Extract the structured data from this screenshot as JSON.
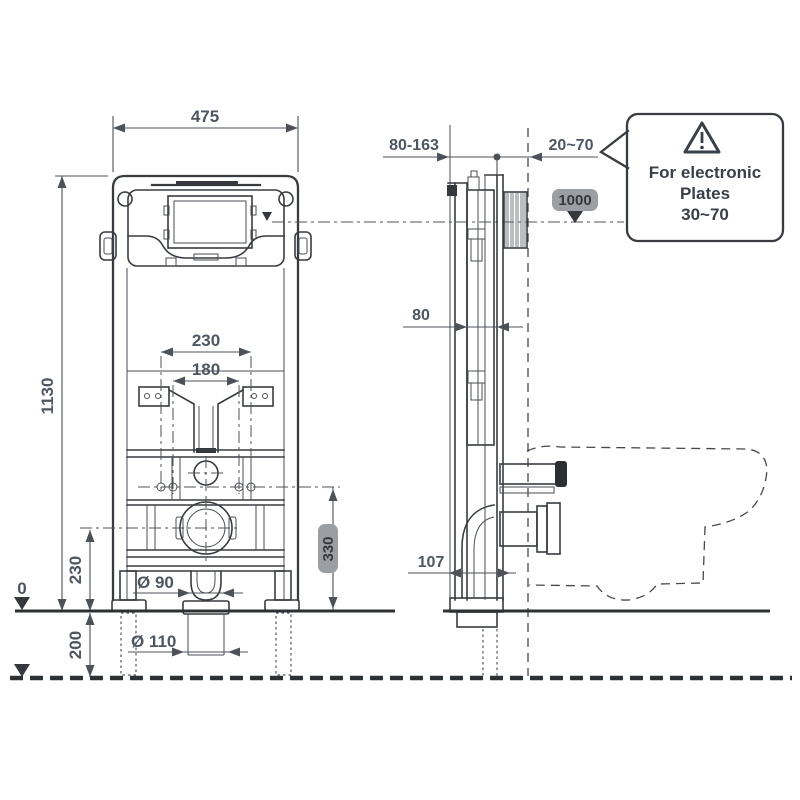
{
  "front_view": {
    "width": "475",
    "height": "1130",
    "fixing_width_outer": "230",
    "fixing_width_inner": "180",
    "outlet_center_height": "230",
    "floor_depth": "200",
    "zero_level": "0",
    "flush_pipe_dia": "Ø 90",
    "drain_pipe_dia": "Ø 110"
  },
  "side_view": {
    "depth_adjust_range": "80-163",
    "wall_finish_range": "20~70",
    "profile_depth": "80",
    "outlet_offset": "107"
  },
  "badges": {
    "plate_height": "1000",
    "outlet_height": "330"
  },
  "callout": {
    "line1": "For electronic",
    "line2": "Plates",
    "line3": "30~70"
  },
  "colors": {
    "line": "#383c40",
    "dim_text": "#4d5661",
    "badge_bg": "#9b9fa3",
    "badge_text": "#36393d",
    "background": "#ffffff"
  }
}
